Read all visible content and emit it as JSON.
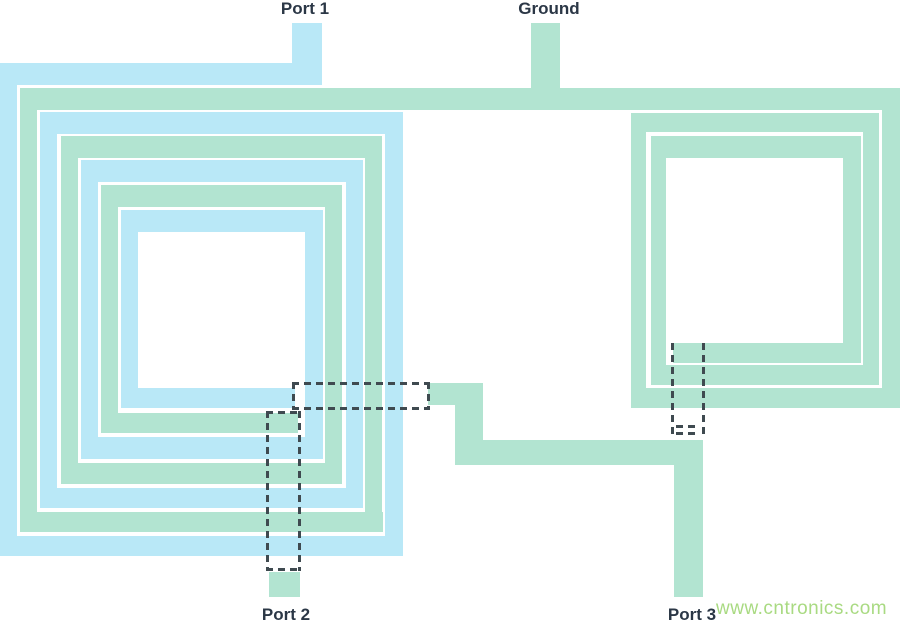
{
  "canvas": {
    "w": 900,
    "h": 625,
    "bg": "#ffffff"
  },
  "colors": {
    "blue": "#b9e8f7",
    "green": "#b2e4d1",
    "dash": "#3f4a50",
    "label_text": "#2b3746",
    "watermark_text": "#a9da82"
  },
  "labels": {
    "port1": {
      "text": "Port 1",
      "cx": 305,
      "y": 0,
      "centered": true
    },
    "ground": {
      "text": "Ground",
      "cx": 549,
      "y": 0,
      "centered": true
    },
    "port2": {
      "text": "Port 2",
      "cx": 286,
      "y": 606,
      "centered": true
    },
    "port3": {
      "text": "Port 3",
      "cx": 692,
      "y": 606,
      "centered": true
    },
    "watermark": {
      "text": "www.cntronics.com",
      "cx": 716,
      "y": 599,
      "centered": false
    }
  },
  "traces": [
    {
      "name": "port1-stub",
      "layer": "blue",
      "x": 292,
      "y": 23,
      "w": 30,
      "h": 41
    },
    {
      "name": "left-spiral-blue-top-1",
      "layer": "blue",
      "x": 0,
      "y": 63,
      "w": 322,
      "h": 22
    },
    {
      "name": "left-spiral-blue-left-1",
      "layer": "blue",
      "x": 0,
      "y": 63,
      "w": 17,
      "h": 493
    },
    {
      "name": "left-spiral-blue-bottom-1",
      "layer": "blue",
      "x": 0,
      "y": 536,
      "w": 403,
      "h": 20
    },
    {
      "name": "left-spiral-blue-right-1",
      "layer": "blue",
      "x": 385,
      "y": 112,
      "w": 18,
      "h": 444
    },
    {
      "name": "left-spiral-blue-top-2",
      "layer": "blue",
      "x": 40,
      "y": 112,
      "w": 363,
      "h": 22
    },
    {
      "name": "left-spiral-blue-left-2",
      "layer": "blue",
      "x": 40,
      "y": 112,
      "w": 17,
      "h": 396
    },
    {
      "name": "left-spiral-blue-bottom-2",
      "layer": "blue",
      "x": 40,
      "y": 488,
      "w": 323,
      "h": 20
    },
    {
      "name": "left-spiral-blue-right-2",
      "layer": "blue",
      "x": 346,
      "y": 160,
      "w": 17,
      "h": 348
    },
    {
      "name": "left-spiral-blue-top-3",
      "layer": "blue",
      "x": 81,
      "y": 160,
      "w": 282,
      "h": 22
    },
    {
      "name": "left-spiral-blue-left-3",
      "layer": "blue",
      "x": 81,
      "y": 160,
      "w": 17,
      "h": 299
    },
    {
      "name": "left-spiral-blue-bottom-3",
      "layer": "blue",
      "x": 81,
      "y": 437,
      "w": 242,
      "h": 22
    },
    {
      "name": "left-spiral-blue-right-3",
      "layer": "blue",
      "x": 305,
      "y": 210,
      "w": 18,
      "h": 249
    },
    {
      "name": "left-spiral-blue-top-4",
      "layer": "blue",
      "x": 121,
      "y": 210,
      "w": 202,
      "h": 22
    },
    {
      "name": "left-spiral-blue-left-4",
      "layer": "blue",
      "x": 121,
      "y": 210,
      "w": 17,
      "h": 198
    },
    {
      "name": "left-spiral-blue-bottom-4",
      "layer": "blue",
      "x": 121,
      "y": 388,
      "w": 174,
      "h": 20
    },
    {
      "name": "ground-stub",
      "layer": "green",
      "x": 531,
      "y": 23,
      "w": 29,
      "h": 65
    },
    {
      "name": "green-top-long-trace",
      "layer": "green",
      "x": 20,
      "y": 88,
      "w": 880,
      "h": 22
    },
    {
      "name": "left-spiral-green-left-1",
      "layer": "green",
      "x": 20,
      "y": 88,
      "w": 17,
      "h": 444
    },
    {
      "name": "left-spiral-green-bottom-1",
      "layer": "green",
      "x": 20,
      "y": 512,
      "w": 363,
      "h": 20
    },
    {
      "name": "left-spiral-green-right-1",
      "layer": "green",
      "x": 365,
      "y": 136,
      "w": 17,
      "h": 396
    },
    {
      "name": "left-spiral-green-top-2",
      "layer": "green",
      "x": 61,
      "y": 136,
      "w": 321,
      "h": 22
    },
    {
      "name": "left-spiral-green-left-2",
      "layer": "green",
      "x": 61,
      "y": 136,
      "w": 17,
      "h": 348
    },
    {
      "name": "left-spiral-green-bottom-2",
      "layer": "green",
      "x": 61,
      "y": 463,
      "w": 281,
      "h": 21
    },
    {
      "name": "left-spiral-green-right-2",
      "layer": "green",
      "x": 325,
      "y": 185,
      "w": 17,
      "h": 299
    },
    {
      "name": "left-spiral-green-top-3",
      "layer": "green",
      "x": 101,
      "y": 185,
      "w": 241,
      "h": 22
    },
    {
      "name": "left-spiral-green-left-3",
      "layer": "green",
      "x": 101,
      "y": 185,
      "w": 17,
      "h": 248
    },
    {
      "name": "left-spiral-green-bottom-3",
      "layer": "green",
      "x": 101,
      "y": 413,
      "w": 197,
      "h": 20
    },
    {
      "name": "connector-horizontal-upper",
      "layer": "green",
      "x": 428,
      "y": 383,
      "w": 55,
      "h": 22
    },
    {
      "name": "connector-vertical",
      "layer": "green",
      "x": 455,
      "y": 383,
      "w": 28,
      "h": 82
    },
    {
      "name": "connector-horizontal-lower",
      "layer": "green",
      "x": 455,
      "y": 440,
      "w": 248,
      "h": 25
    },
    {
      "name": "port3-trace",
      "layer": "green",
      "x": 674,
      "y": 440,
      "w": 29,
      "h": 157
    },
    {
      "name": "port2-stub",
      "layer": "green",
      "x": 269,
      "y": 572,
      "w": 31,
      "h": 25
    },
    {
      "name": "right-spiral-outer-right",
      "layer": "green",
      "x": 882,
      "y": 88,
      "w": 18,
      "h": 320
    },
    {
      "name": "right-spiral-outer-bottom",
      "layer": "green",
      "x": 631,
      "y": 388,
      "w": 269,
      "h": 20
    },
    {
      "name": "right-spiral-outer-left",
      "layer": "green",
      "x": 631,
      "y": 113,
      "w": 15,
      "h": 295
    },
    {
      "name": "right-spiral-ring1-top",
      "layer": "green",
      "x": 631,
      "y": 113,
      "w": 248,
      "h": 19
    },
    {
      "name": "right-spiral-ring1-right",
      "layer": "green",
      "x": 863,
      "y": 113,
      "w": 16,
      "h": 272
    },
    {
      "name": "right-spiral-ring1-bottom",
      "layer": "green",
      "x": 651,
      "y": 365,
      "w": 228,
      "h": 20
    },
    {
      "name": "right-spiral-ring1-left",
      "layer": "green",
      "x": 651,
      "y": 136,
      "w": 15,
      "h": 249
    },
    {
      "name": "right-spiral-ring2-top",
      "layer": "green",
      "x": 651,
      "y": 136,
      "w": 210,
      "h": 22
    },
    {
      "name": "right-spiral-ring2-right",
      "layer": "green",
      "x": 843,
      "y": 136,
      "w": 18,
      "h": 227
    },
    {
      "name": "right-spiral-ring2-bottom",
      "layer": "green",
      "x": 673,
      "y": 343,
      "w": 188,
      "h": 20
    }
  ],
  "dashed_segments": [
    {
      "name": "underpass1-top",
      "dir": "h",
      "x": 292,
      "y": 382,
      "len": 137
    },
    {
      "name": "underpass1-bottom",
      "dir": "h",
      "x": 292,
      "y": 407,
      "len": 137
    },
    {
      "name": "underpass1-left",
      "dir": "v",
      "x": 292,
      "y": 382,
      "len": 28
    },
    {
      "name": "underpass1-right",
      "dir": "v",
      "x": 427,
      "y": 382,
      "len": 28
    },
    {
      "name": "underpass2-top",
      "dir": "h",
      "x": 266,
      "y": 411,
      "len": 35
    },
    {
      "name": "underpass2-bottom",
      "dir": "h",
      "x": 266,
      "y": 568,
      "len": 35
    },
    {
      "name": "underpass2-left",
      "dir": "v",
      "x": 266,
      "y": 411,
      "len": 160
    },
    {
      "name": "underpass2-right",
      "dir": "v",
      "x": 298,
      "y": 411,
      "len": 160
    },
    {
      "name": "underpass3-left",
      "dir": "v",
      "x": 671,
      "y": 343,
      "len": 95
    },
    {
      "name": "underpass3-right",
      "dir": "v",
      "x": 702,
      "y": 343,
      "len": 95
    },
    {
      "name": "underpass3-tick-1",
      "dir": "h",
      "x": 676,
      "y": 425,
      "len": 24
    },
    {
      "name": "underpass3-tick-2",
      "dir": "h",
      "x": 676,
      "y": 432,
      "len": 24
    }
  ]
}
